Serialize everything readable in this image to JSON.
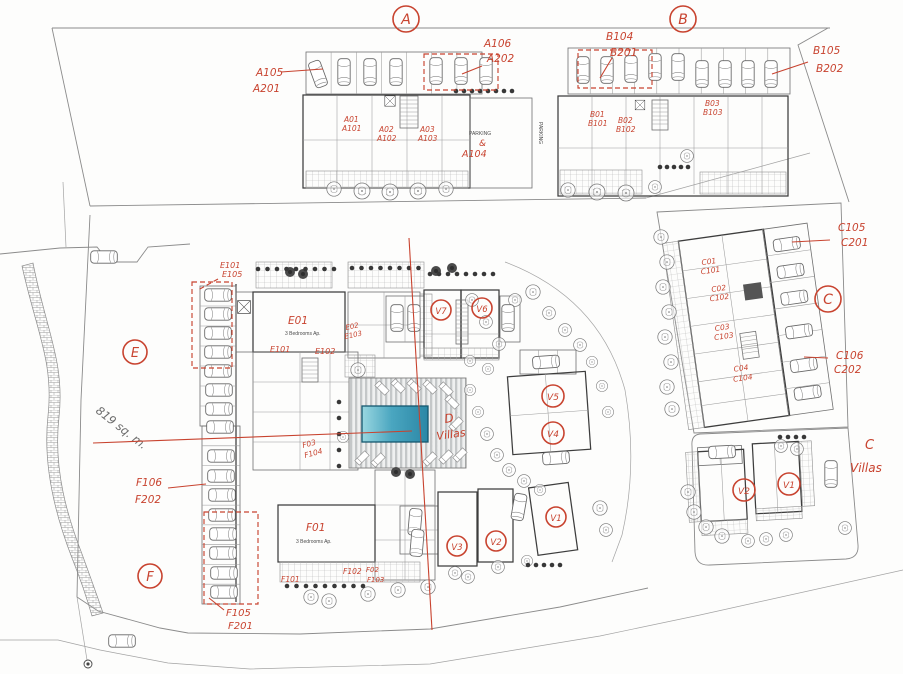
{
  "palette": {
    "red": "#c8432f",
    "pool_light": "#9ad7e0",
    "pool_dark": "#2b87a6"
  },
  "annotations": {
    "circles": {
      "a": "A",
      "b": "B",
      "c": "C",
      "e": "E",
      "f": "F"
    },
    "a": {
      "left1": "A105",
      "left2": "A201",
      "right1": "A106",
      "right2": "A202",
      "u1a": "A01",
      "u1b": "A101",
      "u2a": "A02",
      "u2b": "A102",
      "u3a": "A03",
      "u3b": "A103",
      "parking": "PARKING",
      "amp": "&",
      "p_unit": "A104",
      "parking_side": "PARKING"
    },
    "b": {
      "left1": "B104",
      "left2": "B201",
      "right1": "B105",
      "right2": "B202",
      "u1a": "B01",
      "u1b": "B101",
      "u2a": "B02",
      "u2b": "B102",
      "u3a": "B03",
      "u3b": "B103"
    },
    "c": {
      "top1": "C105",
      "top2": "C201",
      "bot1": "C106",
      "bot2": "C202",
      "u1a": "C01",
      "u1b": "C101",
      "u2a": "C02",
      "u2b": "C102",
      "u3a": "C03",
      "u3b": "C103",
      "u4a": "C04",
      "u4b": "C104"
    },
    "d": {
      "l1": "D",
      "l2": "Villas",
      "v": [
        "V7",
        "V6",
        "V5",
        "V4",
        "V3",
        "V2",
        "V1"
      ]
    },
    "cv": {
      "l1": "C",
      "l2": "Villas",
      "v2": "V2",
      "v1": "V1"
    },
    "e": {
      "p1": "E101",
      "p2": "E105",
      "apt": "E01",
      "type": "3 Bedrooms Ap.",
      "g1": "E101",
      "g2": "E102",
      "s1": "E02",
      "s2": "E103"
    },
    "f": {
      "t1": "F106",
      "t2": "F202",
      "b1": "F105",
      "b2": "F201",
      "apt": "F01",
      "type": "3 Bedrooms Ap.",
      "g1": "F101",
      "g2": "F102",
      "s1": "F02",
      "s2": "F103",
      "n1": "F03",
      "n2": "F104"
    },
    "area": "819 sq. m."
  }
}
